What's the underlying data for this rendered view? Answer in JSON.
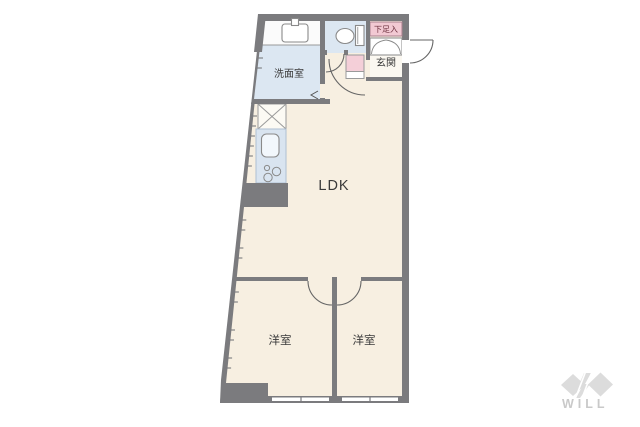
{
  "page": {
    "background": "#ffffff"
  },
  "floor_plan": {
    "labels": {
      "ldk": "LDK",
      "washroom": "洗面室",
      "entrance": "玄関",
      "shoe_storage": "下足入",
      "bedroom_left": "洋室",
      "bedroom_right": "洋室"
    },
    "colors": {
      "wall": "#7b7b7e",
      "floor": "#f7efe1",
      "wet_area": "#dce7f2",
      "counter": "#d9e4f0",
      "pink_accent": "#f4cfd8",
      "shoe_label_bg": "#f2c9d3",
      "shoe_label_text": "#6b2f3d",
      "fixture_line": "#8a8a8a",
      "door_line": "#666666",
      "genkan_floor": "#fbf8f1"
    }
  },
  "branding": {
    "logo_text": "WILL",
    "logo_color": "#c9c9c9"
  }
}
